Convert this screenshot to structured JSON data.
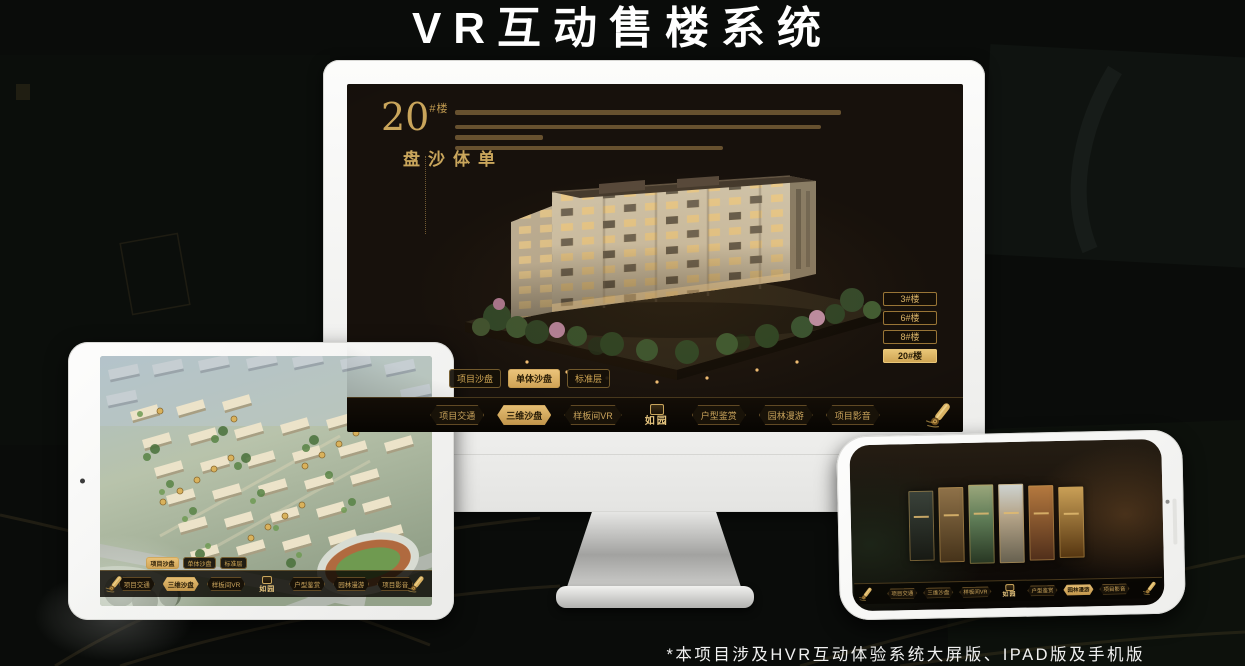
{
  "page": {
    "title": "VR互动售楼系统",
    "footnote": "*本项目涉及HVR互动体验系统大屏版、IPAD版及手机版"
  },
  "colors": {
    "gold_accent": "#d2a855",
    "gold_active_bg": "#ddb469",
    "screen_background": "#17110c"
  },
  "nav": {
    "logo": "如园",
    "items": [
      "项目交通",
      "三维沙盘",
      "样板间VR",
      "户型鉴赏",
      "园林漫游",
      "项目影音"
    ]
  },
  "monitor": {
    "headline": {
      "number": "20",
      "suffix": "#楼",
      "subtitle": "单体沙盘"
    },
    "building_buttons": [
      {
        "label": "3#楼",
        "active": false
      },
      {
        "label": "6#楼",
        "active": false
      },
      {
        "label": "8#楼",
        "active": false
      },
      {
        "label": "20#楼",
        "active": true
      }
    ],
    "tabs": [
      {
        "label": "项目沙盘",
        "active": false
      },
      {
        "label": "单体沙盘",
        "active": true
      },
      {
        "label": "标准层",
        "active": false
      }
    ],
    "nav_active": "三维沙盘"
  },
  "tablet": {
    "tabs": [
      {
        "label": "项目沙盘",
        "active": true
      },
      {
        "label": "单体沙盘",
        "active": false
      },
      {
        "label": "标准层",
        "active": false
      }
    ],
    "nav_active": "三维沙盘"
  },
  "phone": {
    "nav_active": "园林漫游"
  }
}
